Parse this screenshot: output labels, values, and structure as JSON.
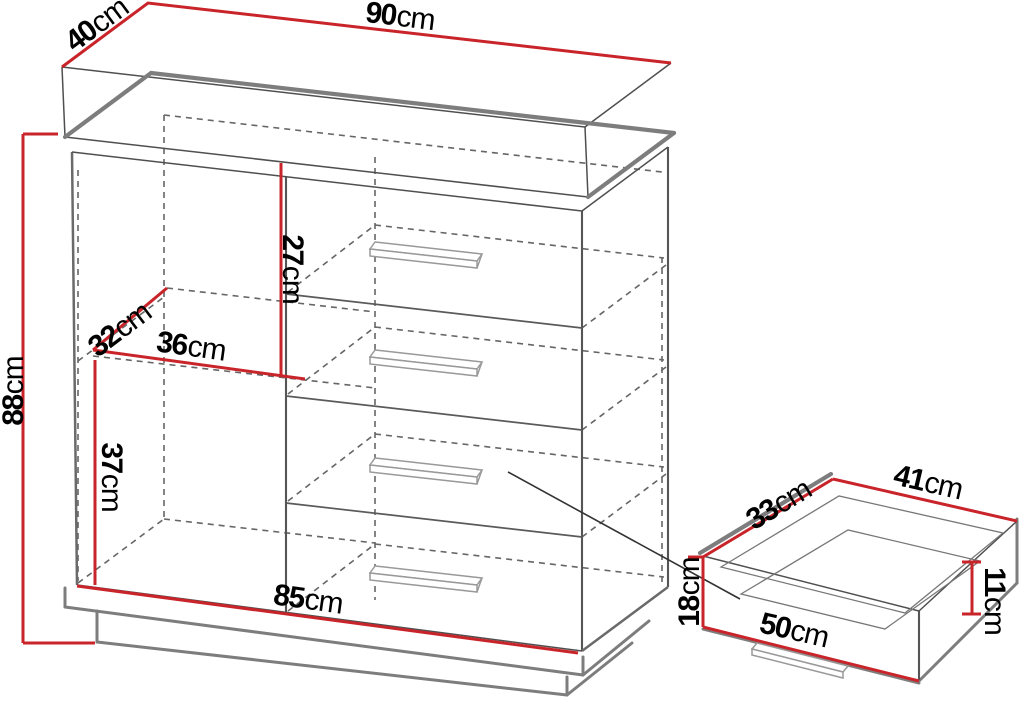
{
  "diagram": {
    "type": "furniture-dimension-diagram",
    "subject": "chest of drawers with one extracted drawer",
    "colors": {
      "dimension_line": "#c9242a",
      "outline_gray": "#7d7d7d",
      "background": "#ffffff"
    }
  },
  "dims": {
    "top_width": {
      "v": "90",
      "u": "cm"
    },
    "top_depth": {
      "v": "40",
      "u": "cm"
    },
    "total_height": {
      "v": "88",
      "u": "cm"
    },
    "upper_section_height": {
      "v": "27",
      "u": "cm"
    },
    "shelf_depth": {
      "v": "32",
      "u": "cm"
    },
    "shelf_width": {
      "v": "36",
      "u": "cm"
    },
    "lower_section_height": {
      "v": "37",
      "u": "cm"
    },
    "base_width": {
      "v": "85",
      "u": "cm"
    },
    "drawer_depth": {
      "v": "33",
      "u": "cm"
    },
    "drawer_width": {
      "v": "41",
      "u": "cm"
    },
    "drawer_side_height": {
      "v": "11",
      "u": "cm"
    },
    "drawer_front_height": {
      "v": "18",
      "u": "cm"
    },
    "drawer_front_width": {
      "v": "50",
      "u": "cm"
    }
  }
}
